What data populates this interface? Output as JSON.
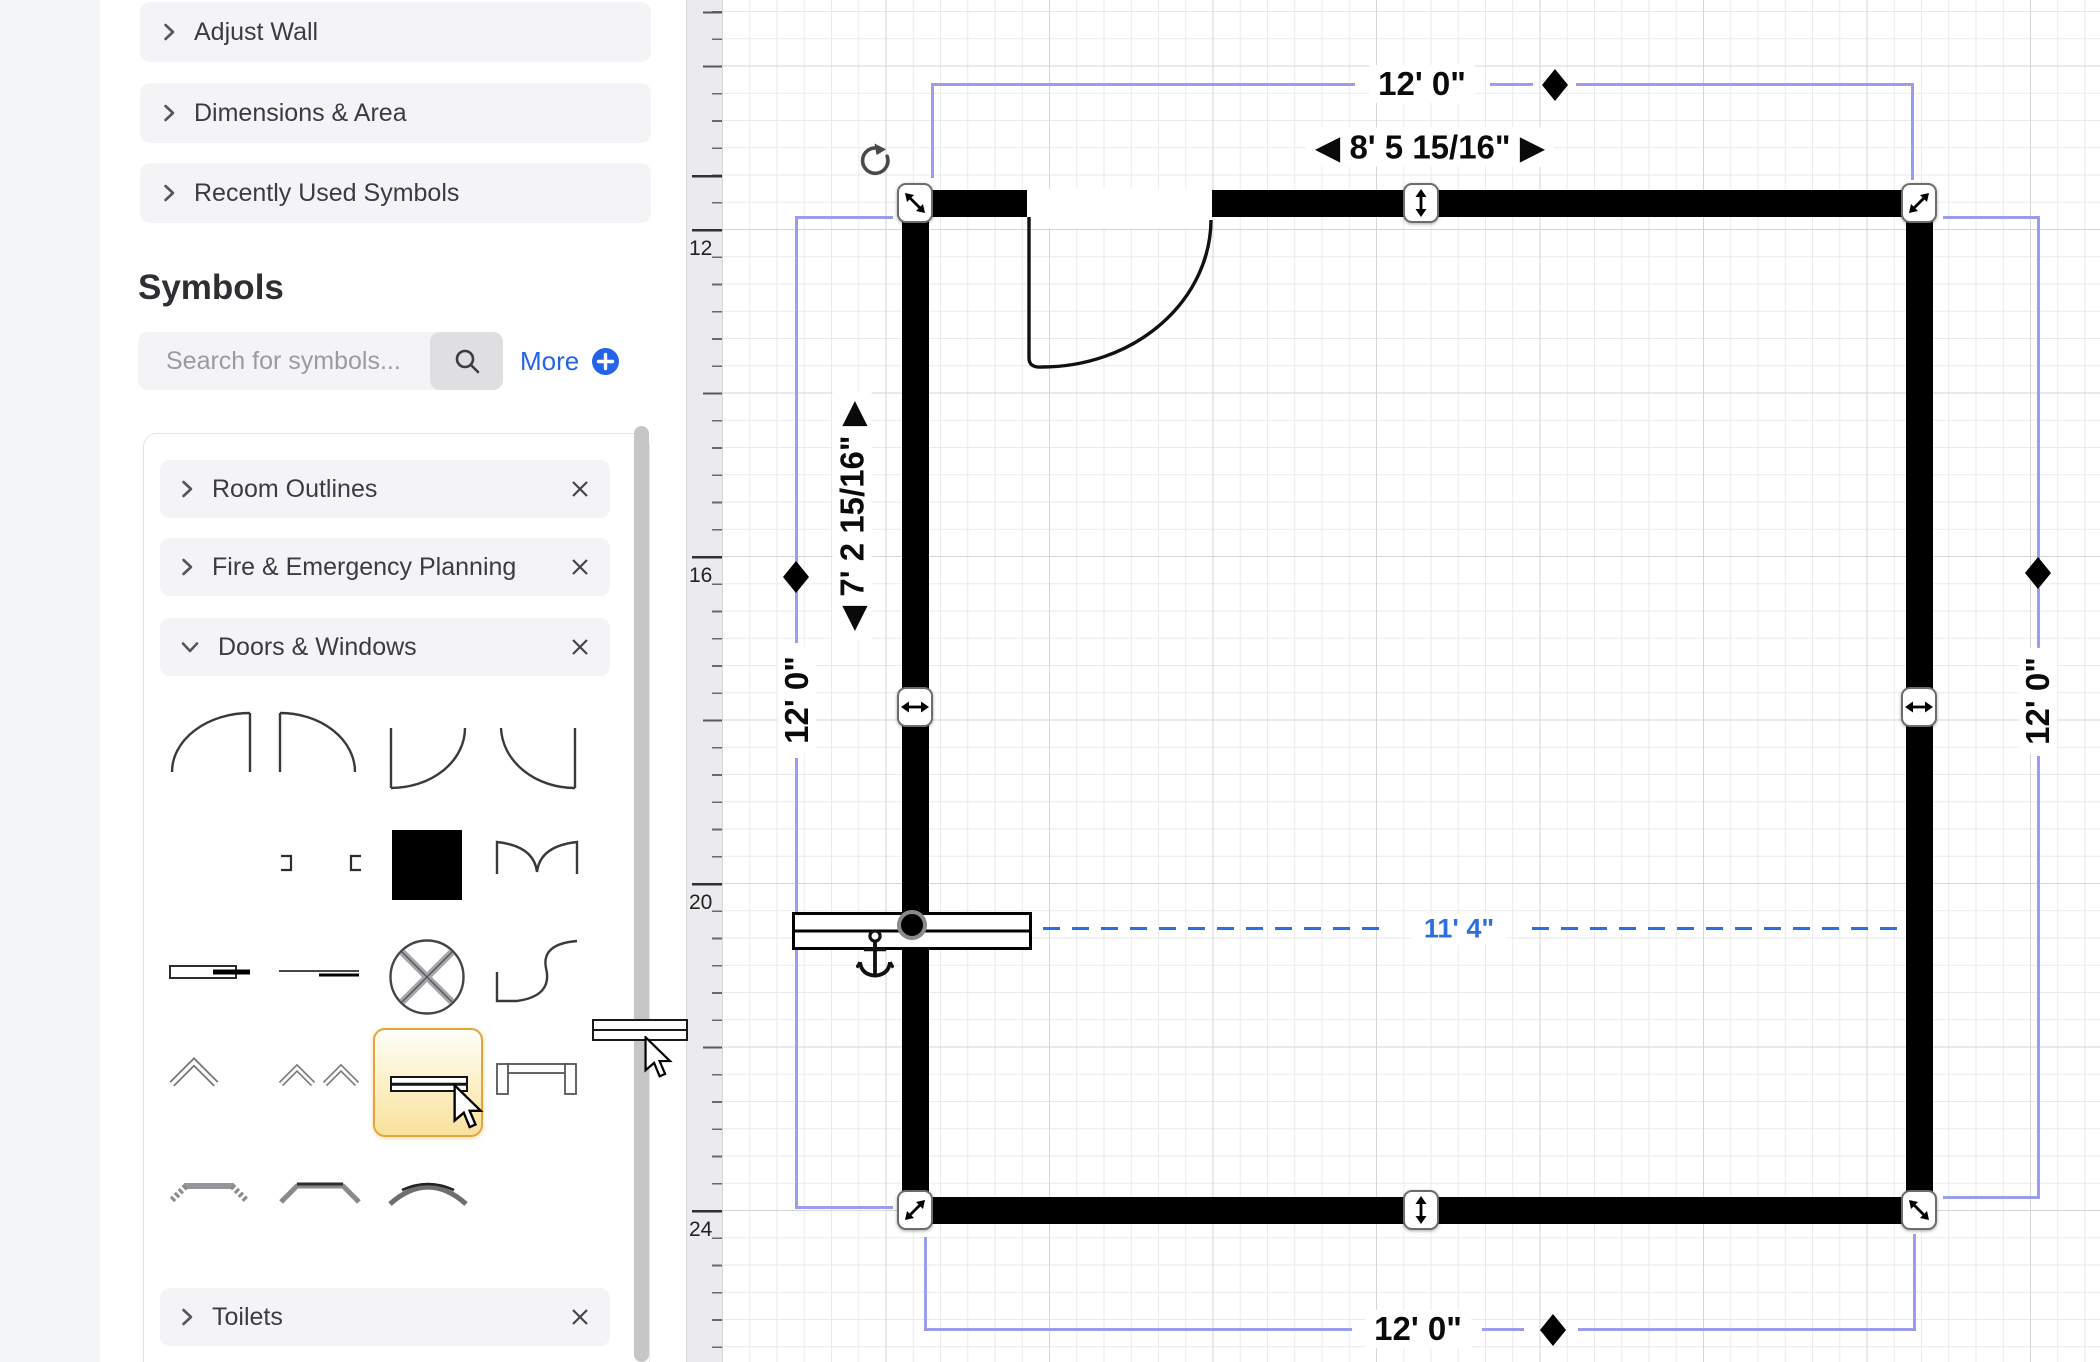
{
  "sidebar": {
    "sections": [
      {
        "label": "Adjust Wall"
      },
      {
        "label": "Dimensions & Area"
      },
      {
        "label": "Recently Used Symbols"
      }
    ],
    "symbols_header": "Symbols",
    "search_placeholder": "Search for symbols...",
    "more_label": "More",
    "categories": [
      {
        "label": "Room Outlines"
      },
      {
        "label": "Fire & Emergency Planning"
      },
      {
        "label": "Doors & Windows"
      },
      {
        "label": "Toilets"
      }
    ]
  },
  "ruler": {
    "labels": [
      "12",
      "16",
      "20",
      "24"
    ]
  },
  "plan": {
    "dim_top": "12' 0\"",
    "dim_bottom": "12' 0\"",
    "dim_left": "12' 0\"",
    "dim_right": "12' 0\"",
    "dim_door": "◀ 8' 5 15/16\" ▶",
    "dim_wall_segment": "◀ 7' 2 15/16\" ▶",
    "dim_window_guide": "11' 4\"",
    "colors": {
      "selection_purple": "#9b9bef",
      "guide_blue": "#2e6fe0",
      "wall_black": "#000000",
      "highlight_orange": "#e5a43c",
      "link_blue": "#2563e8"
    }
  }
}
